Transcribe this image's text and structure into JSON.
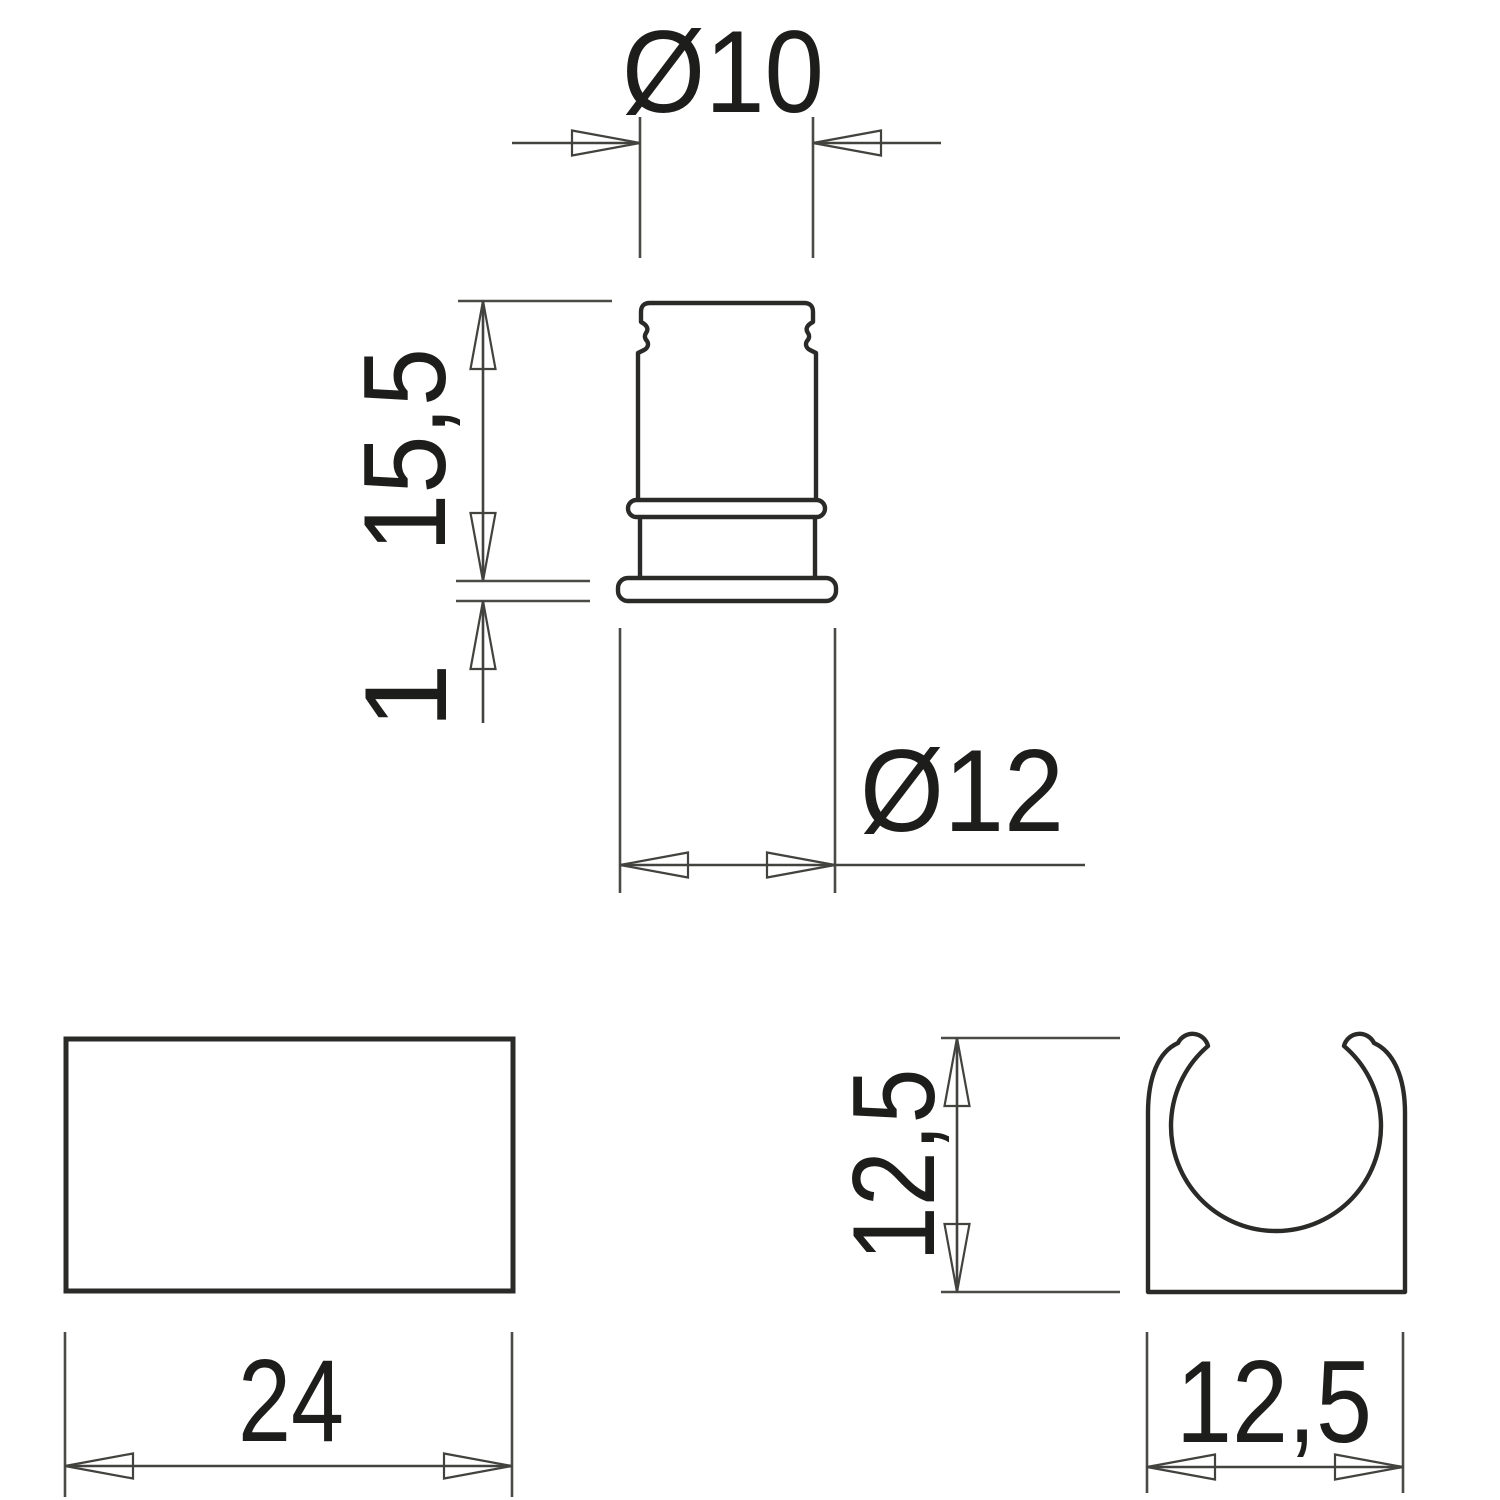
{
  "drawing": {
    "background": "#ffffff",
    "outline_color": "#2a2a28",
    "dimension_color": "#42423f",
    "text_color": "#1d1d1b",
    "dimensions": {
      "top_diameter": "Ø10",
      "body_height": "15,5",
      "flange_thickness": "1",
      "flange_diameter": "Ø12",
      "clip_length": "24",
      "clip_height": "12,5",
      "clip_width": "12,5"
    }
  }
}
